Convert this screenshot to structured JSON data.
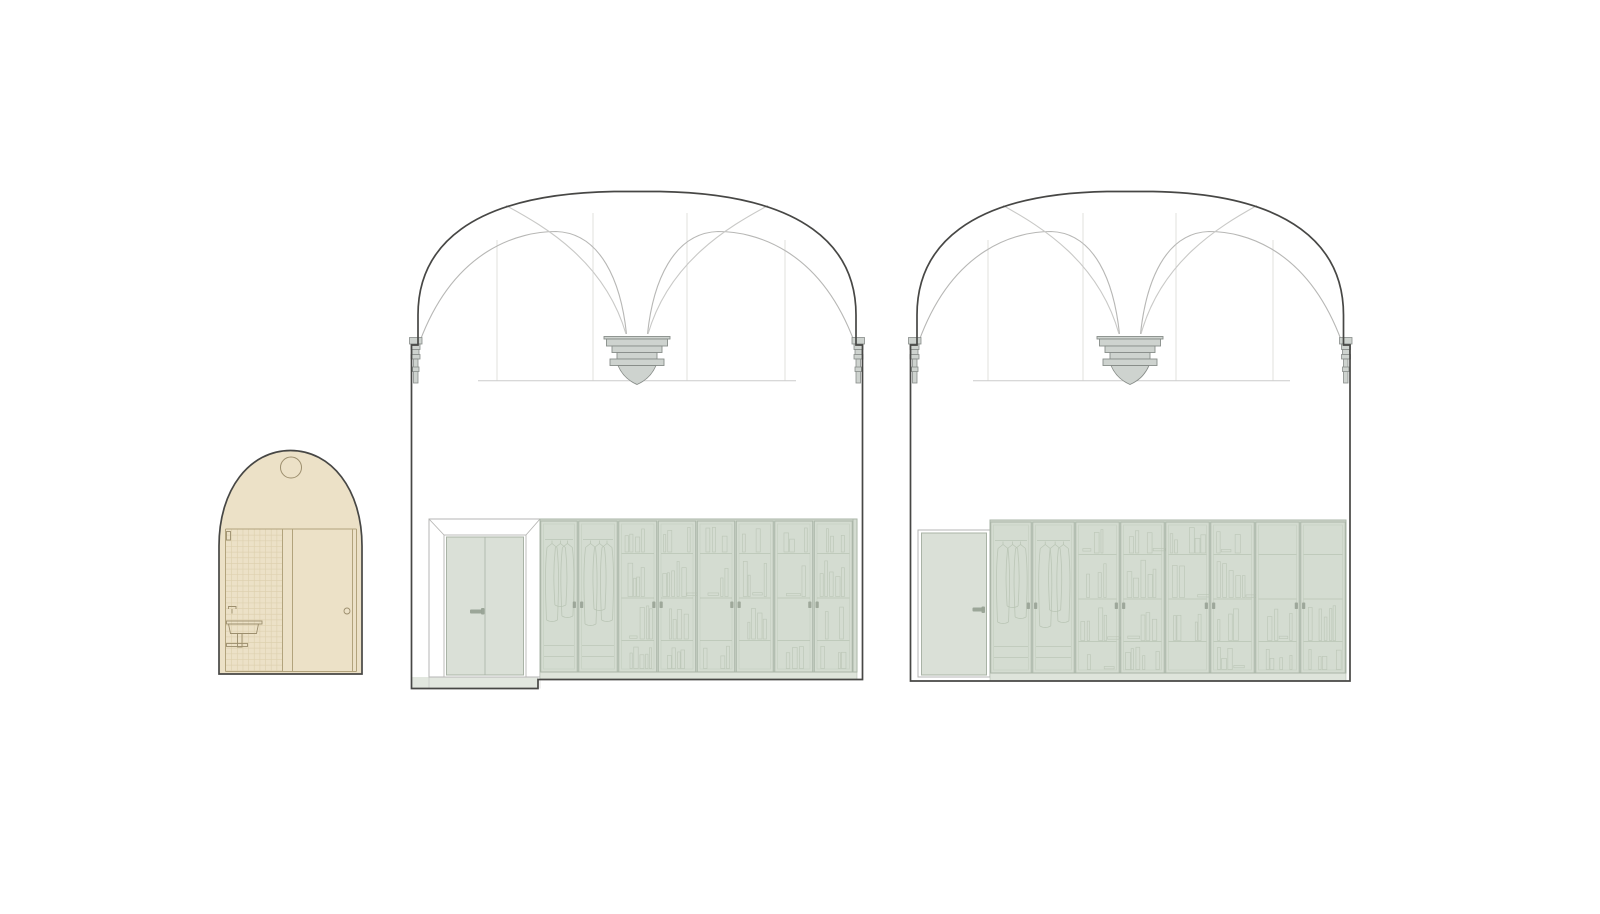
{
  "page": {
    "background": "#ffffff",
    "width": 1600,
    "height": 914
  },
  "colors": {
    "background": "#ffffff",
    "outline": "#474745",
    "beige_fill": "#ece1c7",
    "beige_line": "#b2a37c",
    "tile_line": "#ddd0ae",
    "fixture_line": "#9c8e6d",
    "rib": "#b7b7b5",
    "rib_light": "#c9c9c7",
    "guide": "#e0e0de",
    "cornice": "#cccccb",
    "corbel_fill": "#ced3cf",
    "corbel_stroke": "#888d89",
    "portal_line": "#b6b6b4",
    "door_fill": "#dae0d7",
    "door_stroke": "#a9b3a6",
    "handle": "#98a295",
    "cab_fill": "#d4dcd1",
    "cab_frame": "#aab5a7",
    "cab_inner": "#c7d0c3",
    "cab_content": "#b6c2b2",
    "plinth": "#dee4db",
    "recess_floor": "#e2e7df",
    "white": "#ffffff"
  },
  "bathroom": {
    "name": "bathroom-elevation",
    "arch_d": "M219,674 L219,546 C219,489 250,450.5 290.5,450.5 C331,450.5 362,489 362,546 L362,674 Z",
    "lamp": {
      "cx": 291,
      "cy": 467.5,
      "r": 10.5
    },
    "wall_lines": [
      [
        225.5,
        529,
        356.5,
        529
      ],
      [
        225.5,
        671.5,
        356.5,
        671.5
      ],
      [
        225.5,
        529,
        225.5,
        671.5
      ],
      [
        282.5,
        529,
        282.5,
        671.5
      ],
      [
        292.5,
        529,
        292.5,
        671.5
      ],
      [
        352.5,
        529,
        352.5,
        671.5
      ],
      [
        356.5,
        529,
        356.5,
        671.5
      ]
    ],
    "tiles": {
      "x1": 226,
      "x2": 282.5,
      "y1": 529.5,
      "y2": 671.5,
      "step": 5.65
    },
    "fixtures": [
      {
        "t": "rect",
        "name": "light-switch",
        "x": 226.5,
        "y": 531.5,
        "wd": 4,
        "h": 8.5
      },
      {
        "t": "path",
        "name": "faucet",
        "d": "M228.5,609 L228.5,606.5 L236,606.5 L236,609 M232,609 L232,613.5"
      },
      {
        "t": "rect",
        "name": "sink-rim",
        "x": 226.5,
        "y": 621,
        "wd": 35.5,
        "h": 3
      },
      {
        "t": "path",
        "name": "sink-basin",
        "d": "M228.5,624 L258.5,624 L256.5,633.5 L230.5,633.5 Z"
      },
      {
        "t": "rect",
        "name": "sink-drain-pipe",
        "x": 237.5,
        "y": 633.5,
        "wd": 4.5,
        "h": 13.5
      },
      {
        "t": "rect",
        "name": "towel-rail",
        "x": 226.5,
        "y": 643.5,
        "wd": 21,
        "h": 3
      },
      {
        "t": "circle",
        "name": "door-knob",
        "cx": 347,
        "cy": 611,
        "r": 3
      }
    ]
  },
  "halls": [
    {
      "name": "hall-elevation-a",
      "outline_d": "M411.5,345 L411.5,688.5 L538,688.5 L538,679.5 L862.5,679.5 L862.5,345 L856,345 L856,315 C856,248 806,194 660,191.5 L614,191.5 C468,194 418,248 418,315 L418,345 Z",
      "guides": {
        "verticals": [
          {
            "x": 497,
            "y1": 240
          },
          {
            "x": 593,
            "y1": 213
          },
          {
            "x": 687,
            "y1": 213
          },
          {
            "x": 785,
            "y1": 240
          }
        ],
        "y2": 380.5,
        "cornice": {
          "x1": 478,
          "x2": 796,
          "y": 380.75
        }
      },
      "ribs": [
        "M420,341 C455,248 520,231.5 556,231.5 C601,233 621,282 626.5,334",
        "M506,205.5 C546,227 605,262 626,334",
        "M854,341 C819,248 754,231.5 718,231.5 C673,233 653,282 647.5,334",
        "M768,205.5 C728,227 669,262 648,334"
      ],
      "corbel": {
        "cx": 637,
        "layers": [
          [
            66,
            336.5,
            339
          ],
          [
            61,
            339,
            346
          ],
          [
            50,
            346,
            352.5
          ],
          [
            40,
            352.5,
            359
          ],
          [
            54,
            359,
            365.5
          ]
        ]
      },
      "wall_corbels": [
        {
          "x": 411.5,
          "dir": 1
        },
        {
          "x": 862.5,
          "dir": -1
        }
      ],
      "doorway": {
        "type": "double",
        "outer": [
          429,
          519,
          540,
          677
        ],
        "inner": [
          444,
          535,
          526,
          677
        ],
        "leaf": [
          446.5,
          537,
          523.5,
          675
        ],
        "center_x": 485,
        "handle": {
          "x": 470,
          "y": 609.5,
          "wd": 12,
          "h": 4,
          "dot": [
            481,
            608,
            3.5,
            6.5
          ]
        }
      },
      "recess": {
        "x1": 411.5,
        "x2": 538,
        "top": 677,
        "bottom": 688.5,
        "jambs": [
          429,
          540
        ]
      },
      "cabinets": {
        "x1": 540,
        "x2": 857,
        "top": 519,
        "door_top": 521,
        "door_bottom": 672,
        "plinth": [
          540,
          672,
          317,
          7.5
        ],
        "boundaries": [
          540,
          578,
          618,
          657.5,
          696.5,
          735.5,
          774,
          813.5,
          853
        ],
        "side_panels": [
          [
            853,
            857
          ]
        ],
        "wardrobe_doors": 2,
        "handle_junctions": [
          578,
          657.5,
          735.5,
          813.5
        ],
        "handle_y": 601.5,
        "shelf_ys": [
          553.5,
          598,
          640.5
        ],
        "book_bands": [
          [
            524,
            552
          ],
          [
            557,
            596.5
          ],
          [
            602,
            639
          ],
          [
            644,
            668.5
          ]
        ],
        "rail_y": 539.5,
        "garment_bottoms": [
          620,
          605,
          616
        ],
        "drawer_ys": [
          645.5,
          656.5
        ],
        "seed": 11
      }
    },
    {
      "name": "hall-elevation-b",
      "outline_d": "M910.5,345 L910.5,681 L1350,681 L1350,345 L1343.5,345 L1343.5,315 C1343.5,248 1293.5,194 1153,191.5 L1107,191.5 C966.5,194 917,248 917,315 L917,345 Z",
      "guides": {
        "verticals": [
          {
            "x": 988,
            "y1": 240
          },
          {
            "x": 1083,
            "y1": 213
          },
          {
            "x": 1176,
            "y1": 213
          },
          {
            "x": 1273,
            "y1": 240
          }
        ],
        "y2": 380.5,
        "cornice": {
          "x1": 973,
          "x2": 1290,
          "y": 380.75
        }
      },
      "ribs": [
        "M919,341 C953,248 1016,231.5 1051,231.5 C1095,233 1114,282 1119.5,334",
        "M1003,205.5 C1042,227 1099,262 1119,334",
        "M1341.5,341 C1307,248 1244,231.5 1209,231.5 C1165,233 1146,282 1140.5,334",
        "M1257,205.5 C1218,227 1161,262 1141,334"
      ],
      "corbel": {
        "cx": 1130,
        "layers": [
          [
            66,
            336.5,
            339
          ],
          [
            61,
            339,
            346
          ],
          [
            50,
            346,
            352.5
          ],
          [
            40,
            352.5,
            359
          ],
          [
            54,
            359,
            365.5
          ]
        ]
      },
      "wall_corbels": [
        {
          "x": 910.5,
          "dir": 1
        },
        {
          "x": 1350,
          "dir": -1
        }
      ],
      "doorway": {
        "type": "single",
        "outer": [
          918,
          530,
          990,
          677
        ],
        "leaf": [
          921.5,
          533,
          986.5,
          675
        ],
        "handle": {
          "x": 972.5,
          "y": 607.5,
          "wd": 11,
          "h": 4,
          "dot": [
            981.5,
            606.5,
            3.5,
            6.5
          ]
        }
      },
      "recess": null,
      "cabinets": {
        "x1": 990,
        "x2": 1346,
        "top": 520,
        "door_top": 522,
        "door_bottom": 673,
        "plinth": [
          990,
          673,
          356,
          8
        ],
        "boundaries": [
          990,
          1032,
          1075,
          1120,
          1165,
          1210,
          1255,
          1300,
          1346
        ],
        "side_panels": [],
        "wardrobe_doors": 2,
        "handle_junctions": [
          1032,
          1120,
          1210,
          1300
        ],
        "handle_y": 602.5,
        "shelf_ys": [
          554.5,
          599,
          641.5
        ],
        "book_bands": [
          [
            525,
            553
          ],
          [
            558,
            597.5
          ],
          [
            603,
            640.5
          ],
          [
            645,
            669.5
          ]
        ],
        "rail_y": 540.5,
        "garment_bottoms": [
          622,
          606,
          617
        ],
        "drawer_ys": [
          646.5,
          657.5
        ],
        "seed": 47
      }
    }
  ]
}
